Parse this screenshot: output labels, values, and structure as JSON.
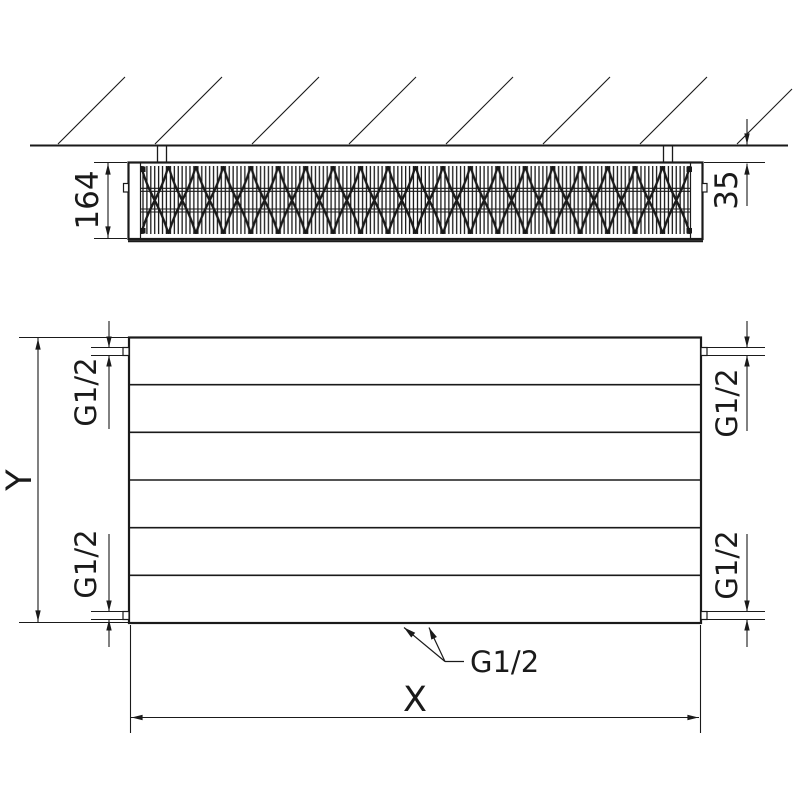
{
  "colors": {
    "line": "#1a1a1a",
    "background": "#ffffff"
  },
  "side_view": {
    "depth_dim_label": "164",
    "wall_gap_dim_label": "35"
  },
  "front_view": {
    "height_dim_label": "Y",
    "width_dim_label": "X",
    "connection_top_left": "G1/2",
    "connection_top_right": "G1/2",
    "connection_bottom_left": "G1/2",
    "connection_bottom_right": "G1/2",
    "connection_bottom_center": "G1/2"
  }
}
